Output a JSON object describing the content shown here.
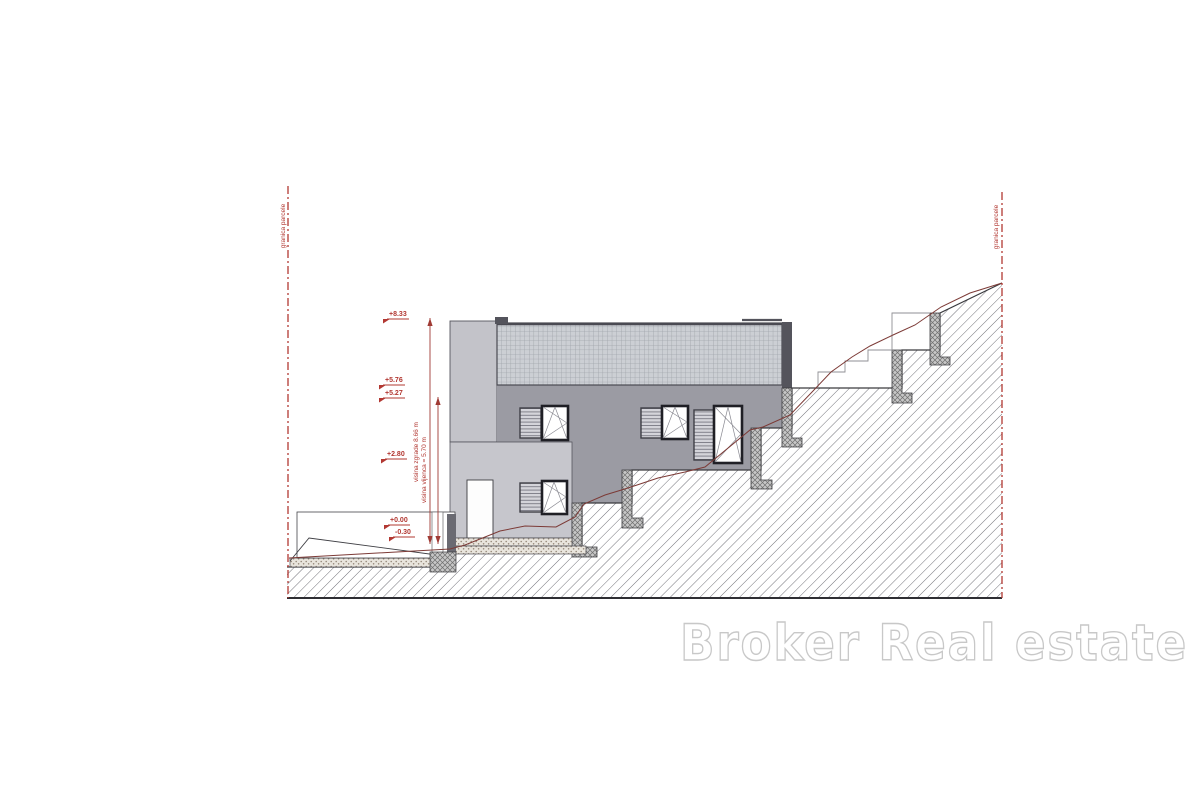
{
  "boundaries": {
    "left_label": "granica parcele",
    "right_label": "granica parcele"
  },
  "dimension_labels": {
    "building_height": "visina zgrade 8.66 m",
    "eaves_height": "visina vijenca = 5.70 m"
  },
  "elevation_marks": [
    "+8.33",
    "+5.76",
    "+5.27",
    "+2.80",
    "+0.00",
    "-0.30"
  ],
  "watermark": {
    "text": "Broker Real estate"
  },
  "colors": {
    "boundary_red": "#b23832",
    "annotation_red": "#b23832",
    "existing_terrain_line": "#7c3a36",
    "building_wall_dark": "#9b9ba3",
    "building_wall_light": "#c6c6cc",
    "window_frame": "#1f1f25",
    "watermark_outline": "#c8c8c8"
  }
}
